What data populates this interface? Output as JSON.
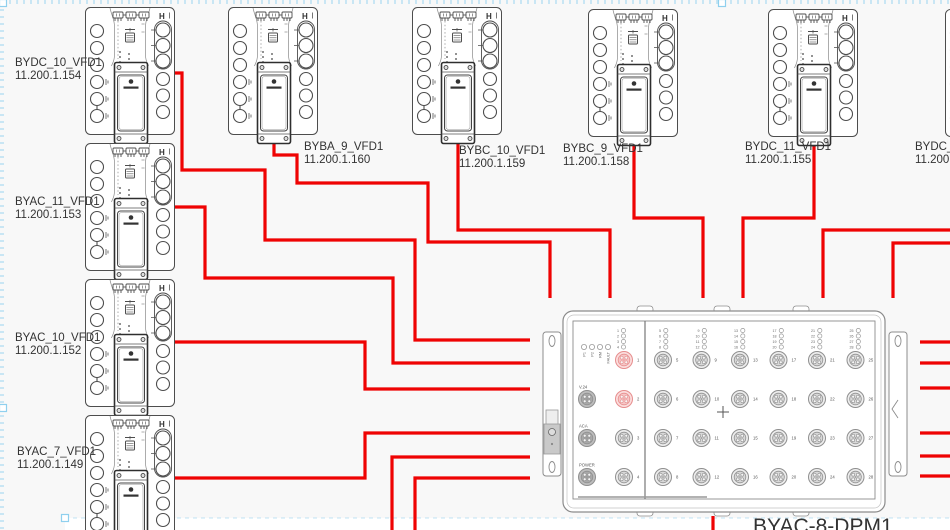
{
  "colors": {
    "background": "#f8f8f8",
    "wire": "#ef0303",
    "device_stroke": "#4d4d4d",
    "dpm_stroke": "#8c8c8c",
    "selection": "#8fd0ee",
    "text": "#333333",
    "port_highlight": "#e68d8d"
  },
  "vfd_units": [
    {
      "name": "BYDC_10_VFD1",
      "ip": "11.200.1.154",
      "corner_mark": "H",
      "x": 85,
      "y": 7,
      "label_x": 15,
      "label_y": 56
    },
    {
      "name": "BYAC_11_VFD1",
      "ip": "11.200.1.153",
      "corner_mark": "H",
      "x": 85,
      "y": 143,
      "label_x": 15,
      "label_y": 195
    },
    {
      "name": "BYAC_10_VFD1",
      "ip": "11.200.1.152",
      "corner_mark": "H",
      "x": 85,
      "y": 279,
      "label_x": 15,
      "label_y": 331
    },
    {
      "name": "BYAC_7_VFD1",
      "ip": "11.200.1.149",
      "corner_mark": "H",
      "x": 85,
      "y": 415,
      "label_x": 17,
      "label_y": 445
    },
    {
      "name": "BYBA_9_VFD1",
      "ip": "11.200.1.160",
      "corner_mark": "H",
      "x": 228,
      "y": 7,
      "label_x": 304,
      "label_y": 140
    },
    {
      "name": "BYBC_10_VFD1",
      "ip": "11.200.1.159",
      "corner_mark": "H",
      "x": 412,
      "y": 7,
      "label_x": 459,
      "label_y": 144
    },
    {
      "name": "BYBC_9_VFD1",
      "ip": "11.200.1.158",
      "corner_mark": "H",
      "x": 588,
      "y": 9,
      "label_x": 563,
      "label_y": 142
    },
    {
      "name": "BYDC_11_VFD1",
      "ip": "11.200.1.155",
      "corner_mark": "H",
      "x": 768,
      "y": 9,
      "label_x": 745,
      "label_y": 140
    },
    {
      "name": "BYDC_12",
      "ip": "11.200.1",
      "corner_mark": "H",
      "x": 945,
      "y": 9,
      "label_x": 915,
      "label_y": 140
    }
  ],
  "dpm": {
    "label": "BYAC-8-DPM1",
    "status_leds": [
      "P1",
      "P2",
      "RM",
      "FAULT"
    ],
    "aux_ports": [
      "V.24",
      "ACA",
      "POWER"
    ],
    "left_port_numbers": [
      1,
      2,
      3,
      4
    ],
    "highlighted_ports": [
      1,
      2
    ],
    "right_port_columns": [
      [
        5,
        6,
        7,
        8
      ],
      [
        9,
        10,
        11,
        12
      ],
      [
        13,
        14,
        15,
        16
      ],
      [
        17,
        18,
        19,
        20
      ],
      [
        21,
        22,
        23,
        24
      ],
      [
        25,
        26,
        27,
        28
      ]
    ],
    "center_mark": "+"
  },
  "wires": [
    {
      "points": [
        [
          175,
          73
        ],
        [
          182,
          73
        ],
        [
          182,
          170
        ],
        [
          265,
          170
        ],
        [
          265,
          240
        ],
        [
          415,
          240
        ],
        [
          415,
          340
        ],
        [
          530,
          340
        ]
      ]
    },
    {
      "points": [
        [
          175,
          207
        ],
        [
          205,
          207
        ],
        [
          205,
          278
        ],
        [
          393,
          278
        ],
        [
          393,
          363
        ],
        [
          530,
          363
        ]
      ]
    },
    {
      "points": [
        [
          175,
          342
        ],
        [
          365,
          342
        ],
        [
          365,
          389
        ],
        [
          530,
          389
        ]
      ]
    },
    {
      "points": [
        [
          175,
          478
        ],
        [
          365,
          478
        ],
        [
          365,
          433
        ],
        [
          530,
          433
        ]
      ]
    },
    {
      "points": [
        [
          392,
          530
        ],
        [
          392,
          457
        ],
        [
          530,
          457
        ]
      ]
    },
    {
      "points": [
        [
          415,
          530
        ],
        [
          415,
          478
        ],
        [
          530,
          478
        ]
      ]
    },
    {
      "points": [
        [
          274,
          143
        ],
        [
          274,
          155
        ],
        [
          297,
          155
        ],
        [
          297,
          183
        ],
        [
          428,
          183
        ],
        [
          428,
          242
        ],
        [
          550,
          242
        ],
        [
          550,
          298
        ]
      ]
    },
    {
      "points": [
        [
          458,
          143
        ],
        [
          458,
          230
        ],
        [
          610,
          230
        ],
        [
          610,
          298
        ]
      ]
    },
    {
      "points": [
        [
          634,
          145
        ],
        [
          634,
          218
        ],
        [
          703,
          218
        ],
        [
          703,
          298
        ]
      ]
    },
    {
      "points": [
        [
          814,
          145
        ],
        [
          814,
          218
        ],
        [
          743,
          218
        ],
        [
          743,
          298
        ]
      ]
    },
    {
      "points": [
        [
          950,
          230
        ],
        [
          823,
          230
        ],
        [
          823,
          298
        ]
      ]
    },
    {
      "points": [
        [
          950,
          243
        ],
        [
          893,
          243
        ],
        [
          893,
          298
        ]
      ]
    },
    {
      "points": [
        [
          920,
          342
        ],
        [
          950,
          342
        ]
      ]
    },
    {
      "points": [
        [
          920,
          363
        ],
        [
          950,
          363
        ]
      ]
    },
    {
      "points": [
        [
          920,
          388
        ],
        [
          950,
          388
        ]
      ]
    },
    {
      "points": [
        [
          920,
          433
        ],
        [
          950,
          433
        ]
      ]
    },
    {
      "points": [
        [
          920,
          456
        ],
        [
          950,
          456
        ]
      ]
    },
    {
      "points": [
        [
          920,
          476
        ],
        [
          950,
          476
        ]
      ]
    },
    {
      "points": [
        [
          713,
          516
        ],
        [
          713,
          530
        ]
      ]
    }
  ]
}
